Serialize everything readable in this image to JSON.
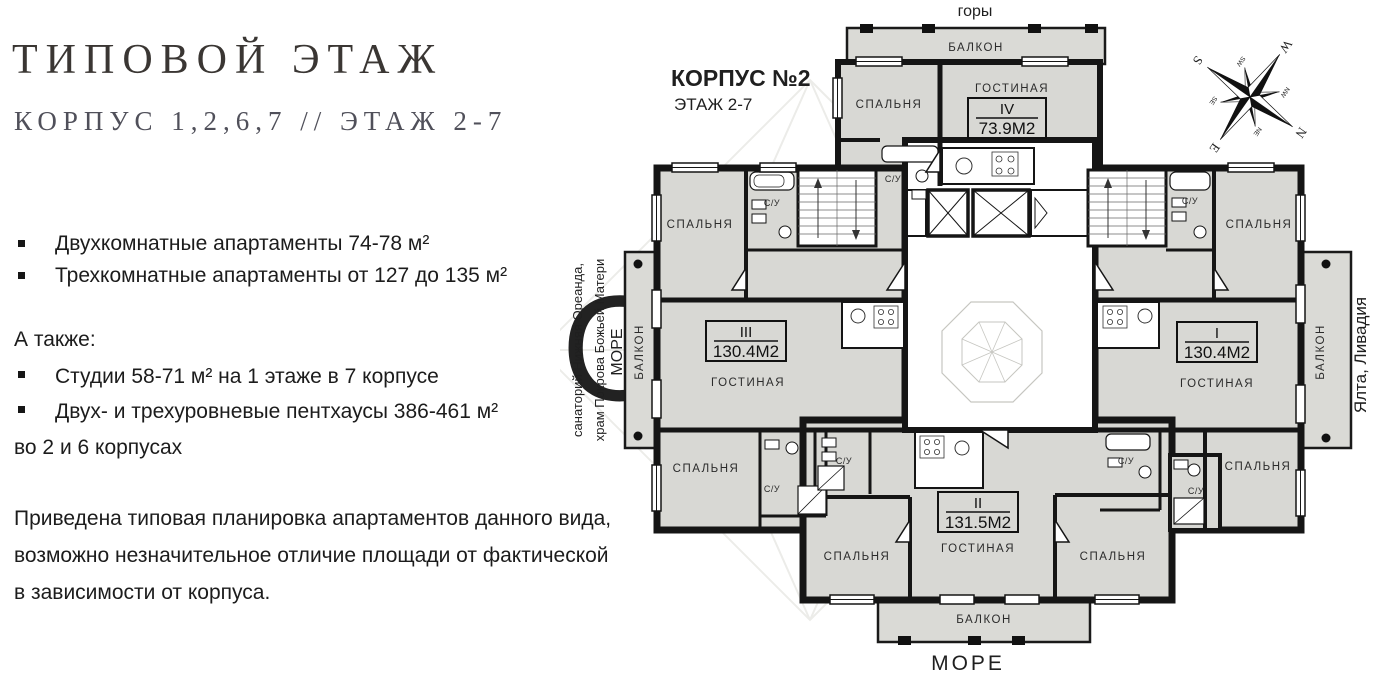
{
  "left_panel": {
    "title": "ТИПОВОЙ ЭТАЖ",
    "subtitle": "КОРПУС 1,2,6,7 // ЭТАЖ 2-7",
    "bullets_main": [
      "Двухкомнатные апартаменты 74-78 м²",
      "Трехкомнатные апартаменты от 127 до 135 м²"
    ],
    "also_label": "А также:",
    "bullets_also": [
      "Студии 58-71 м² на 1 этаже в 7 корпусе",
      "Двух- и трехуровневые пентхаусы  386-461 м²"
    ],
    "also_tail": "во 2 и 6 корпусах",
    "note": "Приведена типовая планировка апартаментов данного вида, возможно незначительное отличие площади от фактической в зависимости от корпуса."
  },
  "plan": {
    "korpus": "КОРПУС №2",
    "etazh": "ЭТАЖ 2-7",
    "surroundings": {
      "top": "горы",
      "bottom": "МОРЕ",
      "right": "Ялта, Ливадия",
      "left_line1": "санаторий Нижняя Ореанда,",
      "left_line2": "храм Покрова Божьей Матери",
      "left_sea": "МОРЕ"
    },
    "rooms": {
      "bedroom": "СПАЛЬНЯ",
      "living": "ГОСТИНАЯ",
      "bath": "С/У",
      "balcony": "БАЛКОН"
    },
    "apartments": [
      {
        "num": "IV",
        "area": "73.9М2"
      },
      {
        "num": "III",
        "area": "130.4М2"
      },
      {
        "num": "I",
        "area": "130.4М2"
      },
      {
        "num": "II",
        "area": "131.5М2"
      }
    ],
    "watermark": {
      "brand": "ONYX",
      "caption": "realestate"
    },
    "compass": {
      "n": "N",
      "e": "E",
      "s": "S",
      "w": "W",
      "ne": "NE",
      "se": "SE",
      "sw": "SW",
      "nw": "NW"
    }
  },
  "colors": {
    "room_fill": "#d8d8d4",
    "wall": "#151515",
    "title_text": "#3a3633",
    "subtitle_text": "#50505a"
  }
}
